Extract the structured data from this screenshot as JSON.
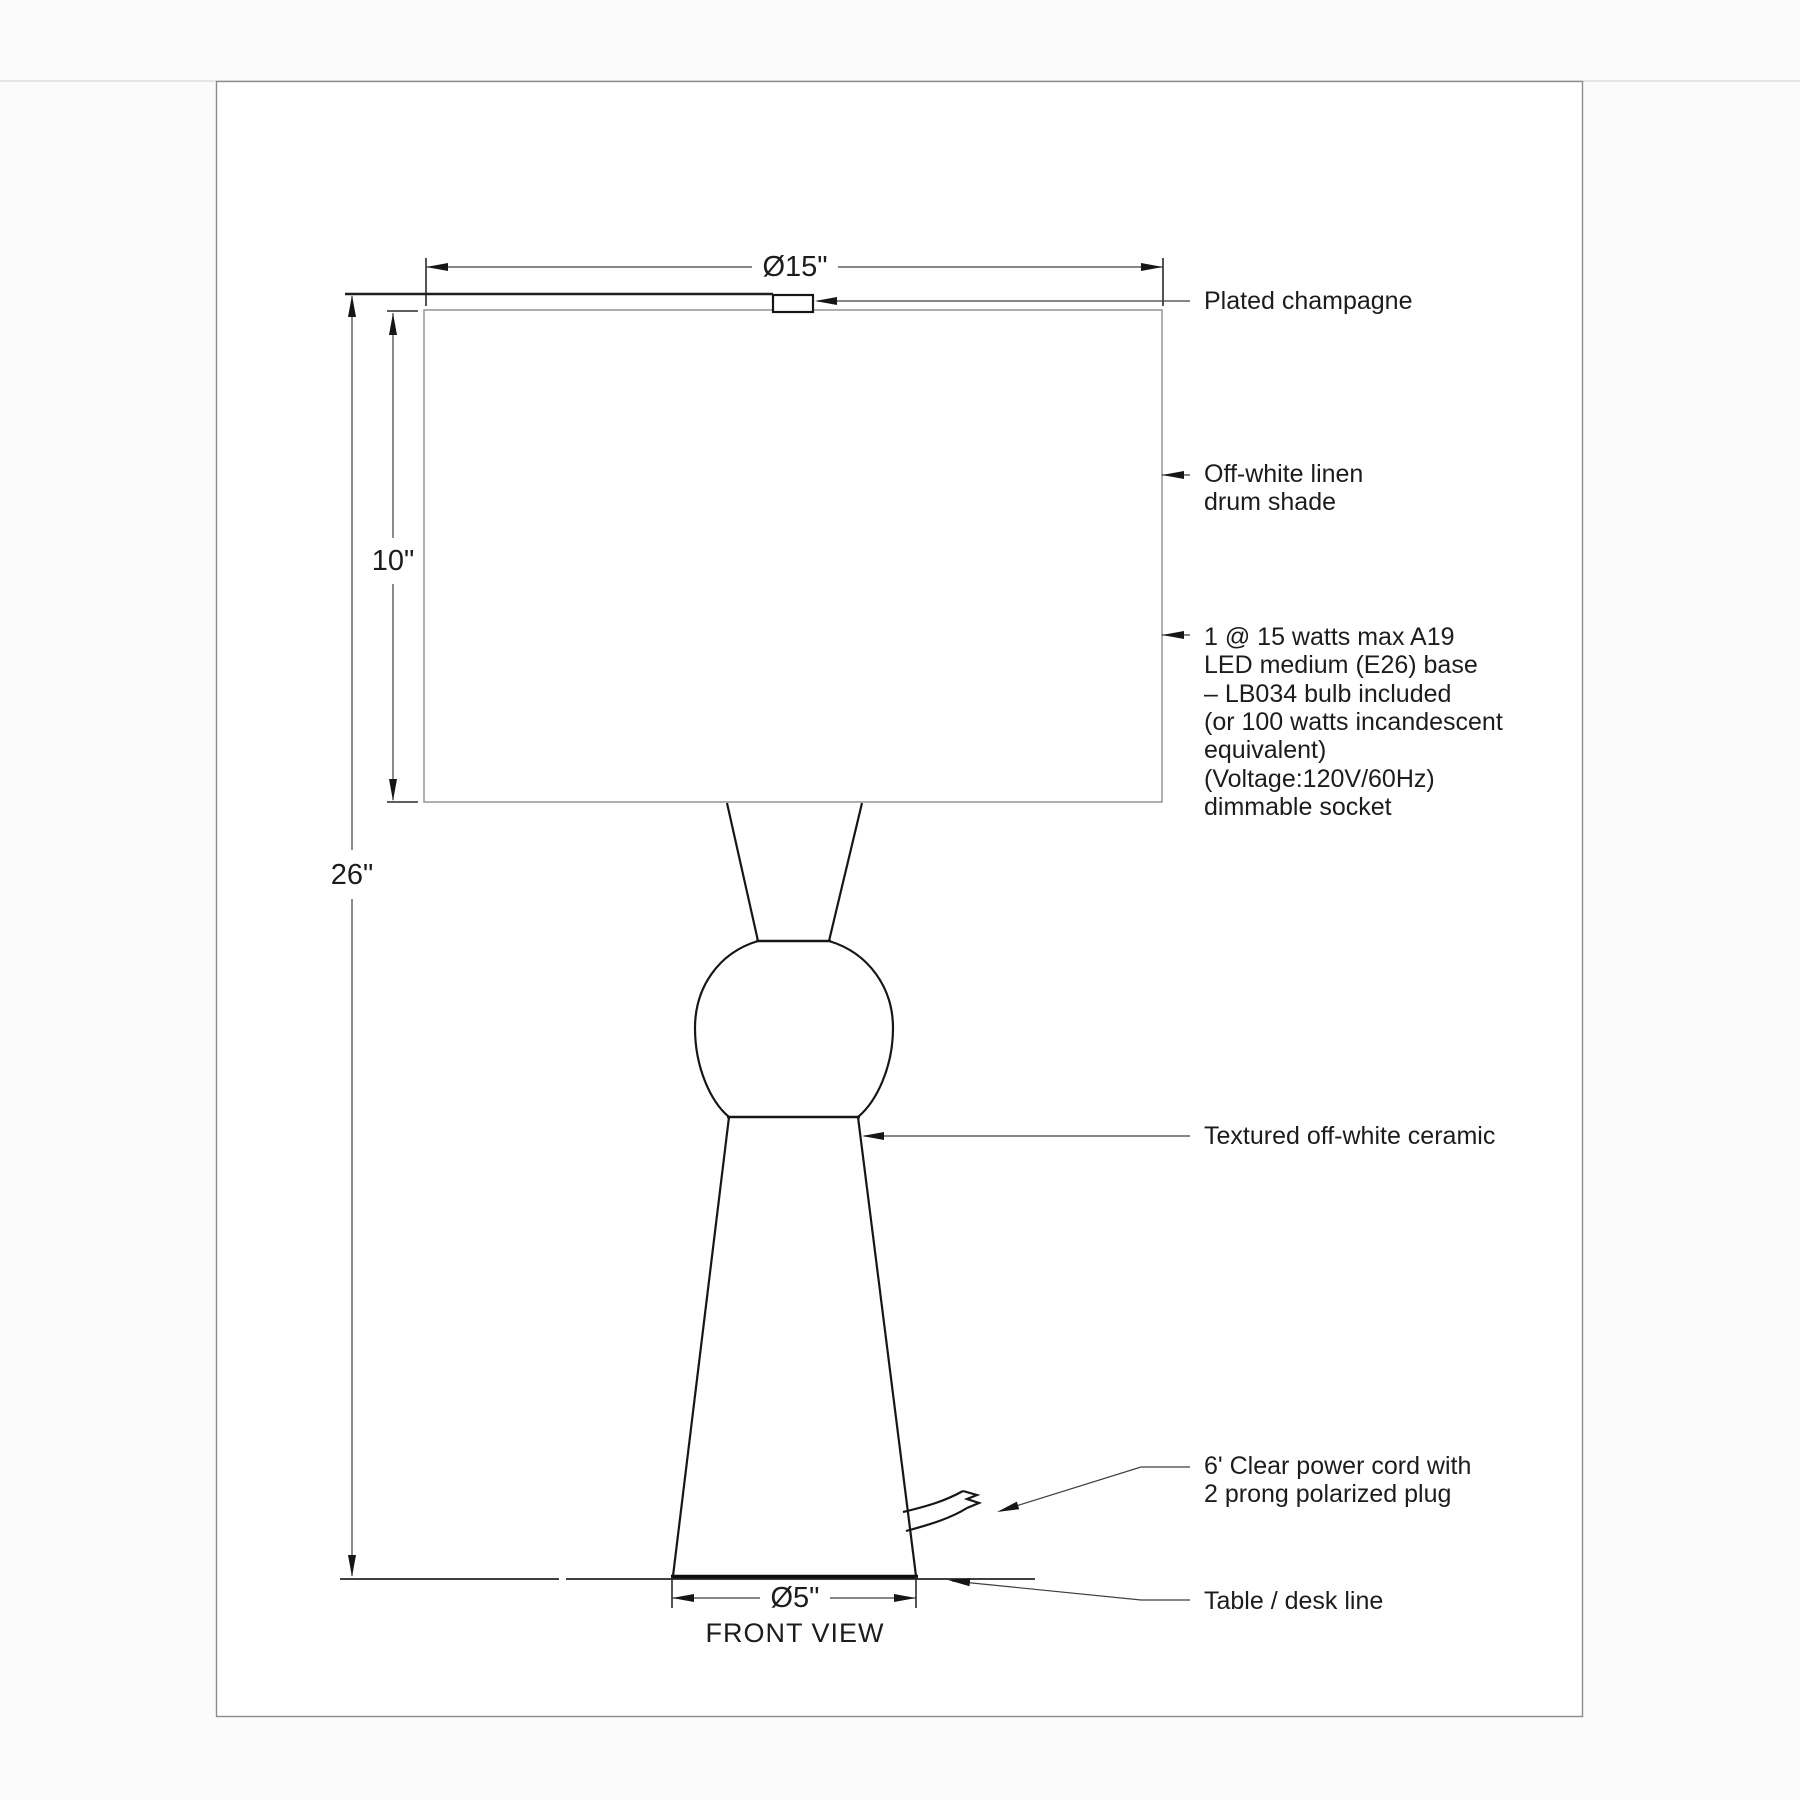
{
  "page": {
    "view_label": "FRONT VIEW"
  },
  "dimensions": {
    "shade_diameter": "Ø15\"",
    "shade_height": "10\"",
    "total_height": "26\"",
    "base_diameter": "Ø5\""
  },
  "annotations": {
    "finial": {
      "label": "Plated champagne"
    },
    "shade": {
      "lines": [
        "Off-white linen",
        "drum shade"
      ]
    },
    "bulb": {
      "lines": [
        "1 @ 15 watts max A19",
        "LED medium (E26) base",
        "– LB034 bulb included",
        "(or 100 watts incandescent",
        "equivalent)",
        "(Voltage:120V/60Hz)",
        "dimmable socket"
      ]
    },
    "body": {
      "label": "Textured off-white ceramic"
    },
    "cord": {
      "lines": [
        "6' Clear power cord with",
        "2 prong polarized plug"
      ]
    },
    "table": {
      "label": "Table / desk line"
    }
  },
  "colors": {
    "line": "#161616",
    "dimension_line": "#3f3f3f",
    "shade_outline": "#9b9b9b",
    "frame_border": "#8c8c8c",
    "background": "#ffffff"
  }
}
